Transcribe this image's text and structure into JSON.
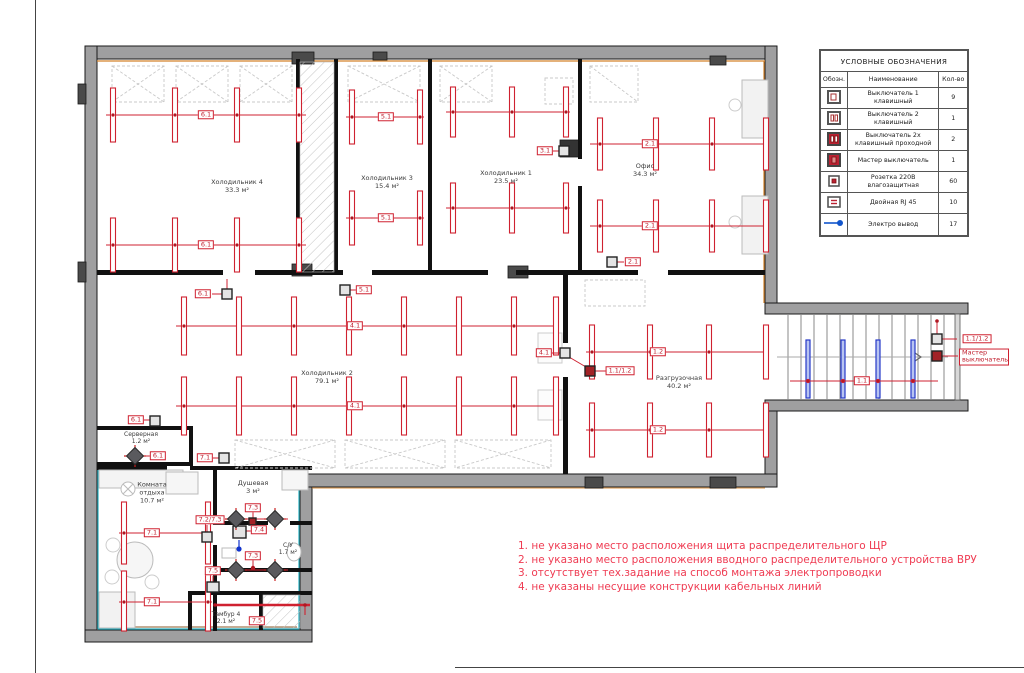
{
  "legend": {
    "title": "УСЛОВНЫЕ ОБОЗНАЧЕНИЯ",
    "columns": {
      "symbol": "Обозн.",
      "name": "Наименование",
      "qty": "Кол-во"
    },
    "rows": [
      {
        "icon": "switch-1-key-icon",
        "name": "Выключатель 1 клавишный",
        "qty": "9"
      },
      {
        "icon": "switch-2-key-icon",
        "name": "Выключатель 2 клавишный",
        "qty": "1"
      },
      {
        "icon": "switch-2-key-pass-icon",
        "name": "Выключатель 2х клавишный проходной",
        "qty": "2"
      },
      {
        "icon": "master-switch-icon",
        "name": "Мастер выключатель",
        "qty": "1"
      },
      {
        "icon": "socket-220v-icon",
        "name": "Розетка 220В влагозащитная",
        "qty": "60"
      },
      {
        "icon": "double-rj45-icon",
        "name": "Двойная RJ 45",
        "qty": "10"
      },
      {
        "icon": "electric-outlet-line-icon",
        "name": "Электро вывод",
        "qty": "17"
      }
    ]
  },
  "rooms": {
    "hall4": {
      "name": "Холодильник 4",
      "area": "33.3 м²"
    },
    "hall3": {
      "name": "Холодильник 3",
      "area": "15.4 м²"
    },
    "hall1": {
      "name": "Холодильник 1",
      "area": "23.5 м²"
    },
    "office": {
      "name": "Офис",
      "area": "34.3 м²"
    },
    "hall2": {
      "name": "Холодильник 2",
      "area": "79.1 м²"
    },
    "unload": {
      "name": "Разгрузочная",
      "area": "40.2 м²"
    },
    "server": {
      "name": "Серверная",
      "area": "1.2 м²"
    },
    "lounge": {
      "name": "Комната отдыха",
      "area": "10.7 м²"
    },
    "shower": {
      "name": "Душевая",
      "area": "3 м²"
    },
    "wc": {
      "name": "С/У",
      "area": "1.7 м²"
    },
    "tambour": {
      "name": "Тамбур 4",
      "area": "2.1 м²"
    }
  },
  "circuits": {
    "hall4": "6.1",
    "hall3": "5.1",
    "hall1": "3.1",
    "office": "2.1",
    "hall2": "4.1",
    "unload": "1.2",
    "stairs": "1.1",
    "lounge": "7.1",
    "combo": "1.1/1.2",
    "master": "Мастер выключатель",
    "shower_switch": "7.2/7.3",
    "c73": "7.3",
    "c74": "7.4",
    "c75": "7.5"
  },
  "notes": [
    "1. не указано место расположения щита распределительного ЩР",
    "2. не указано место расположения вводного распределительного устройства ВРУ",
    "3. отсутствует тех.задание на способ монтажа электропроводки",
    "4. не указаны несущие конструкции кабельных линий"
  ],
  "colors": {
    "wiring_red": "#cf2130",
    "wall_gray": "#9f9fa0",
    "stairs_blue": "#2538c8",
    "accent_orange": "#d4822a",
    "accent_cyan": "#2ab3c4"
  }
}
